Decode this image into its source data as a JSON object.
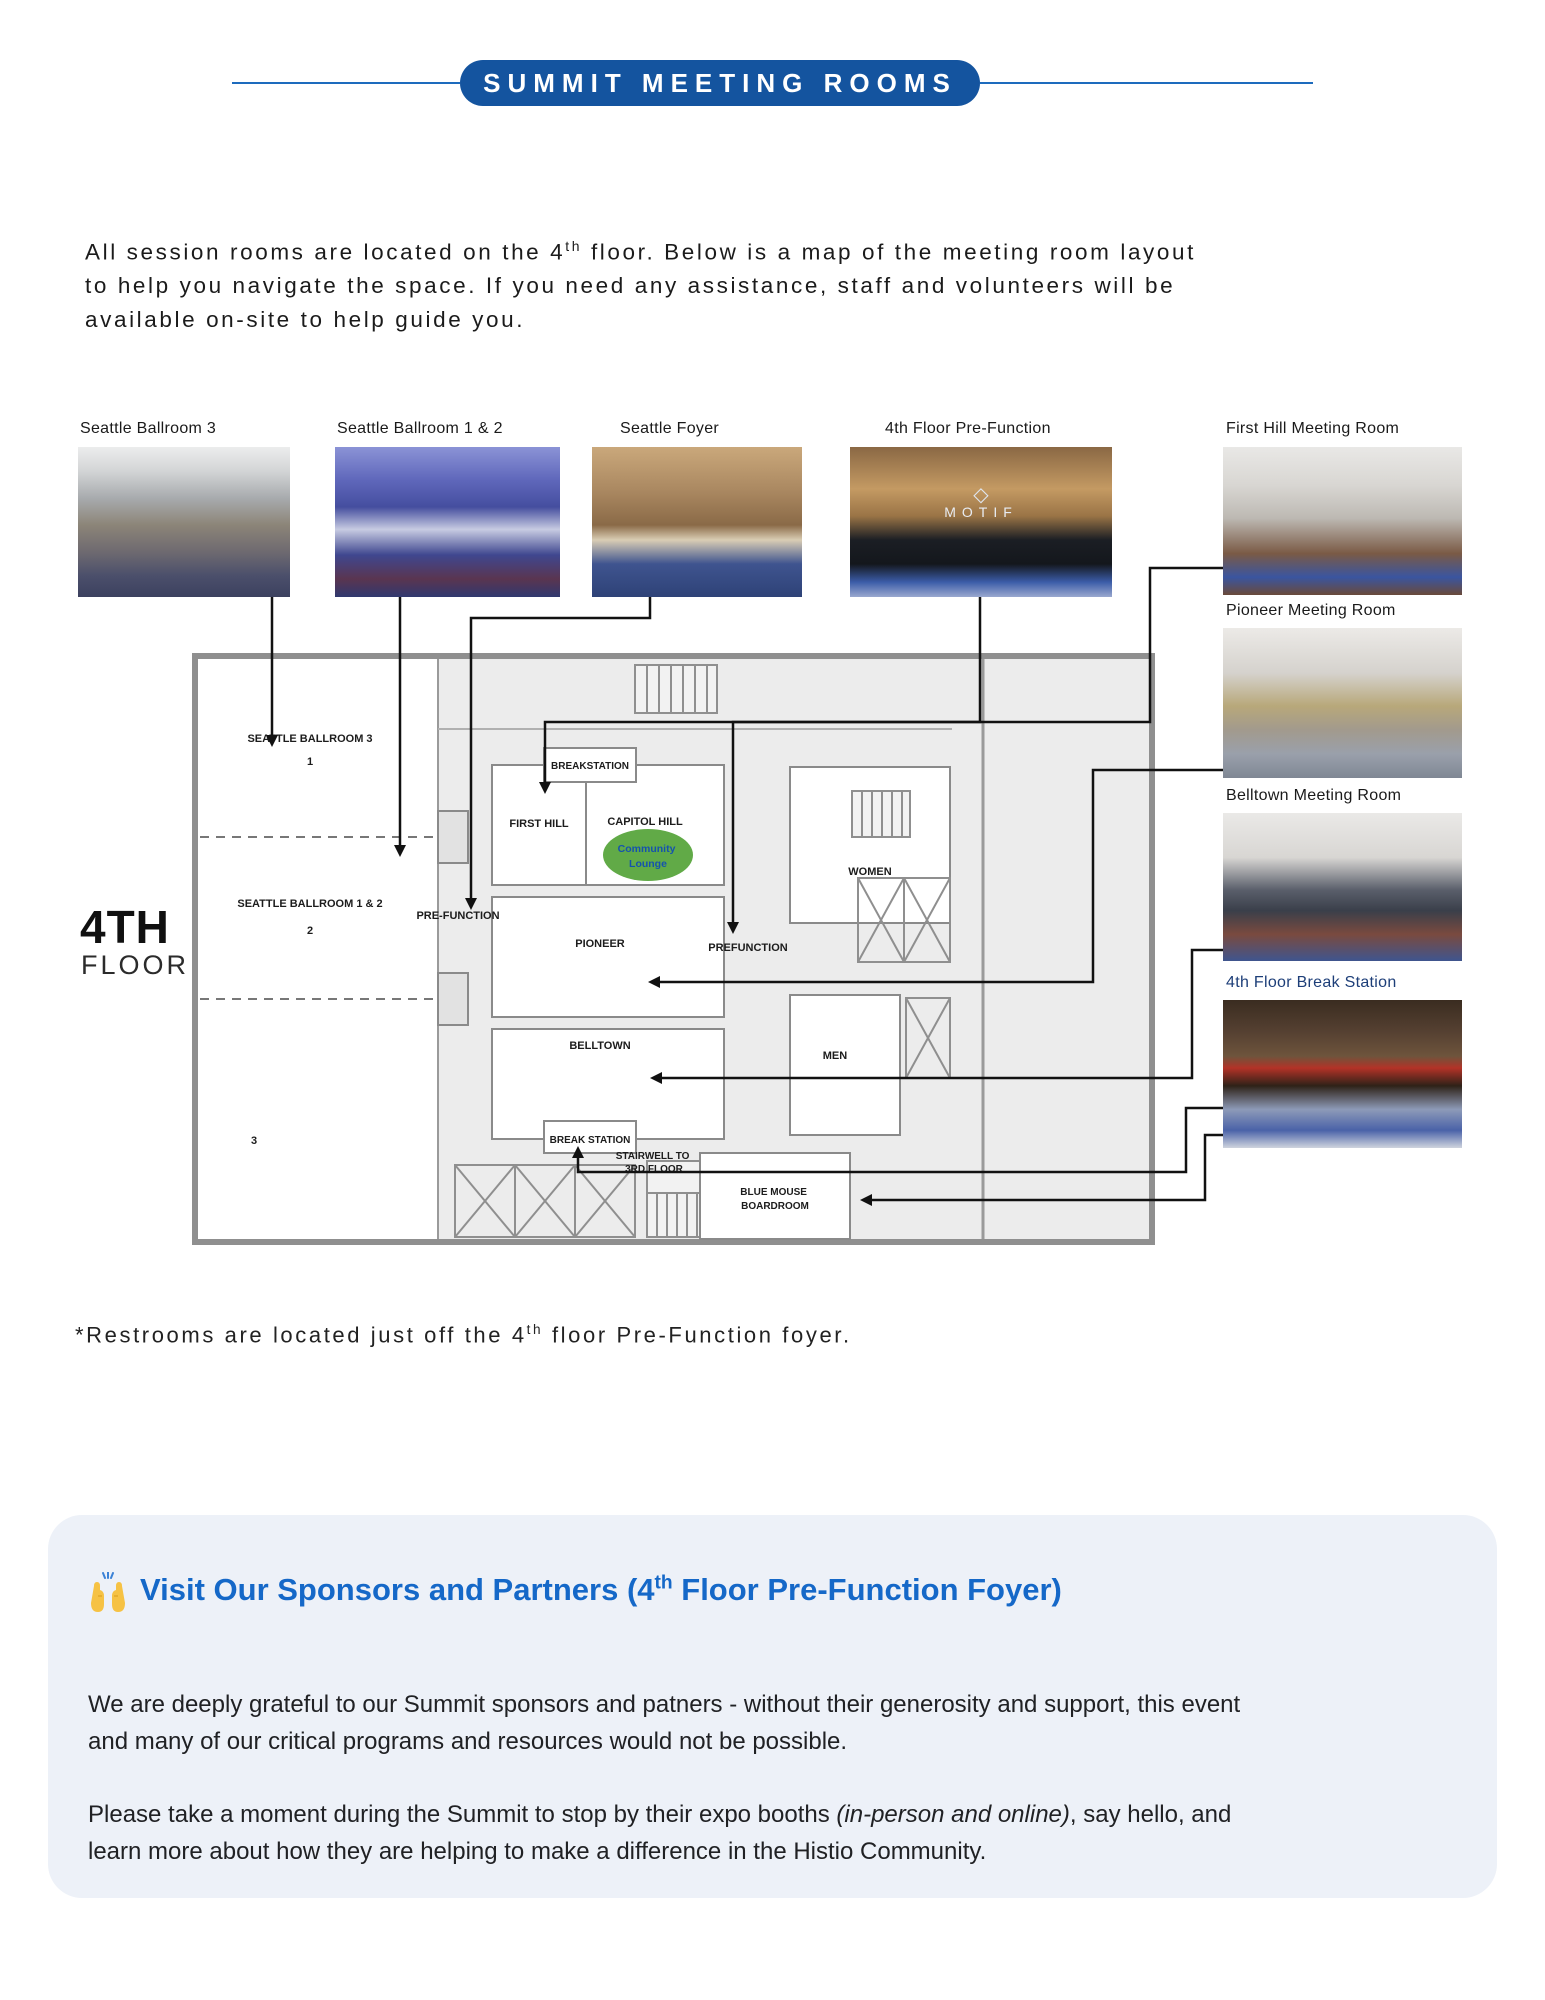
{
  "header": {
    "badge": "SUMMIT MEETING ROOMS"
  },
  "intro": {
    "line1_pre": "All session rooms are located on the 4",
    "sup": "th",
    "line1_post": " floor. Below is a map of the meeting room layout",
    "line2": "to help you navigate the space. If you need any assistance, staff and volunteers will be",
    "line3": "available on-site to help guide you."
  },
  "photos": {
    "top_row": [
      {
        "caption": "Seattle Ballroom 3"
      },
      {
        "caption": "Seattle Ballroom 1 & 2"
      },
      {
        "caption": "Seattle Foyer"
      },
      {
        "caption": "4th Floor Pre-Function",
        "overlay": "MOTIF"
      }
    ],
    "side": [
      {
        "caption": "First Hill Meeting Room"
      },
      {
        "caption": "Pioneer Meeting Room"
      },
      {
        "caption": "Belltown Meeting Room"
      },
      {
        "caption": "4th Floor Break Station"
      }
    ]
  },
  "floor_plan": {
    "big_label": "4TH",
    "small_label": "FLOOR",
    "ballroom3": "SEATTLE BALLROOM 3",
    "num1": "1",
    "ballroom12": "SEATTLE BALLROOM 1 & 2",
    "num2": "2",
    "num3": "3",
    "prefunction_left": "PRE-FUNCTION",
    "breakstation_top": "BREAKSTATION",
    "first_hill": "FIRST HILL",
    "capitol_hill": "CAPITOL HILL",
    "lounge_line1": "Community",
    "lounge_line2": "Lounge",
    "women": "WOMEN",
    "pioneer": "PIONEER",
    "prefunction_mid": "PREFUNCTION",
    "men": "MEN",
    "belltown": "BELLTOWN",
    "break_station": "BREAK STATION",
    "stairwell_line1": "STAIRWELL TO",
    "stairwell_line2": "3RD FLOOR",
    "bluemouse_line1": "BLUE MOUSE",
    "bluemouse_line2": "BOARDROOM"
  },
  "footnote": {
    "pre": "*Restrooms are located just off the 4",
    "sup": "th",
    "post": " floor Pre-Function foyer."
  },
  "sponsors": {
    "heading_pre": "Visit Our Sponsors and Partners (4",
    "heading_sup": "th",
    "heading_post": " Floor Pre-Function Foyer)",
    "p1_line1": "We are deeply grateful to our Summit sponsors and patners - without their generosity and support, this event",
    "p1_line2": "and many of our critical programs and resources would not be possible.",
    "p2_pre": "Please take a moment during the Summit to stop by their expo booths ",
    "p2_italic": "(in-person and online)",
    "p2_mid": ", say hello, and",
    "p2_line2": "learn more about how they are helping to make a difference in the Histio Community."
  },
  "colors": {
    "badge_blue": "#14549f",
    "rule_blue": "#1d6bbd",
    "heading_blue": "#1568c8",
    "break_caption_blue": "#1d3e78",
    "lounge_green": "#61aa47",
    "lounge_text_blue": "#1553ad"
  }
}
